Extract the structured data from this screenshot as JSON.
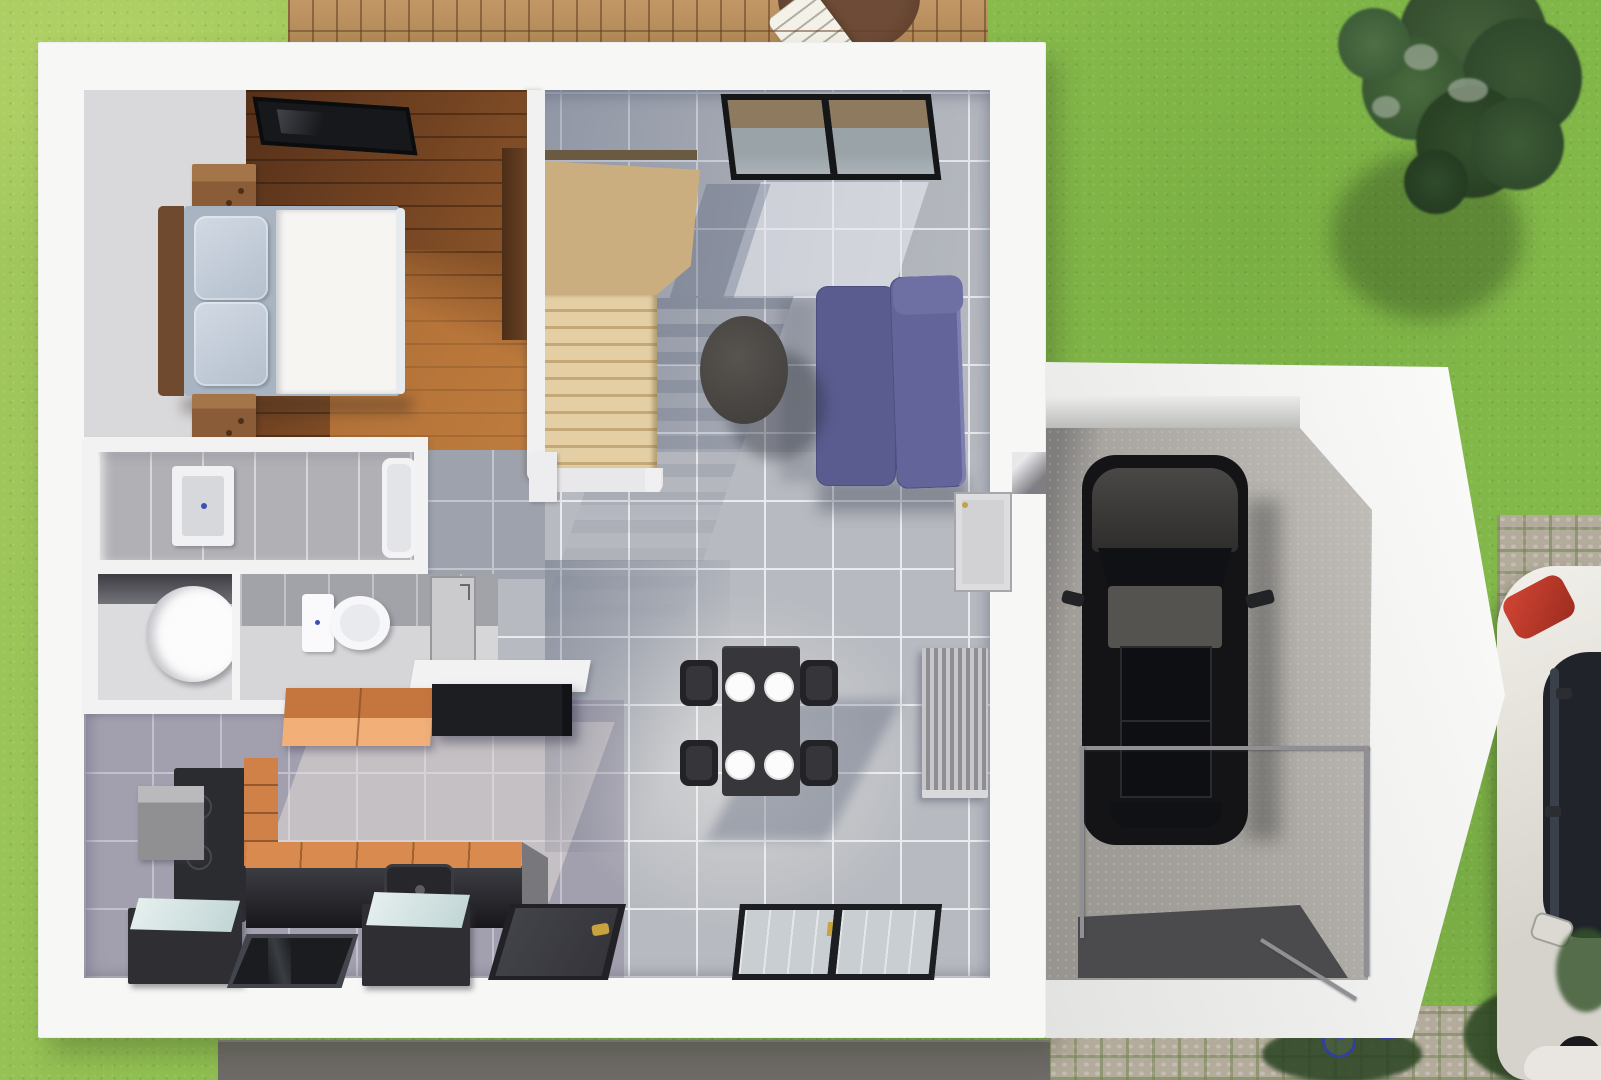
{
  "scene": {
    "type": "3d-floor-plan-render",
    "title": "Top-down 3D rendering of a house ground floor with attached garage, lawn, wooden deck and paved driveway",
    "palette": {
      "grass": "#8abc4e",
      "deck_wood": "#b9905f",
      "wall_white": "#f5f5f4",
      "bedroom_wood_floor": "#7b4b2a",
      "stairs_wood": "#d9c49c",
      "tile_living": "#b7bac0",
      "tile_shadow": "#8e96a8",
      "tile_kitchen": "#8f8b9e",
      "sofa_purple": "#5c5e92",
      "counter_orange": "#d98a4e",
      "counter_black": "#232327",
      "concrete": "#a7a49f",
      "cobblestone": "#b3ab9b",
      "black_car": "#141417",
      "white_car": "#ece9e4",
      "taillight_red": "#c43b2e",
      "tree_green": "#3a5233",
      "path_gray": "#6f6b68",
      "fixture_blue_dot": "#3d4fb5"
    },
    "areas": {
      "bedroom": {
        "label": "bedroom",
        "objects": [
          "double-bed",
          "pillows",
          "white-duvet",
          "nightstand",
          "nightstand",
          "wardrobe",
          "roof-window"
        ]
      },
      "staircase": {
        "label": "winder-staircase",
        "objects": [
          "wood-treads",
          "landing"
        ]
      },
      "living_dining": {
        "label": "living-dining-room",
        "objects": [
          "purple-sofa",
          "round-coffee-table",
          "dining-table",
          "four-chairs",
          "four-plates",
          "radiator",
          "sliding-window",
          "bottom-window",
          "front-door",
          "entry-door",
          "wall-niche"
        ]
      },
      "bathroom": {
        "label": "bathroom",
        "objects": [
          "shower-tray",
          "bathtub"
        ]
      },
      "utility": {
        "label": "utility-room",
        "objects": [
          "water-heater-cylinder"
        ]
      },
      "wc": {
        "label": "wc",
        "objects": [
          "toilet"
        ]
      },
      "kitchen": {
        "label": "kitchen",
        "objects": [
          "orange-wall-cabinet",
          "black-wall-cabinet",
          "cooktop-unit",
          "microwave-box",
          "drawer-cabinet",
          "counter-with-sink",
          "glass-top-appliance",
          "glass-top-appliance",
          "glass-floor-panel"
        ]
      },
      "garage": {
        "label": "garage",
        "objects": [
          "black-car",
          "concrete-floor",
          "glass-railing",
          "dark-mat"
        ]
      },
      "exterior": {
        "label": "exterior",
        "objects": [
          "lawn",
          "wooden-deck",
          "deck-table",
          "lounge-chair",
          "trees",
          "cobblestone-driveway",
          "white-car",
          "red-taillight",
          "bicycle",
          "gray-path",
          "bushes"
        ]
      }
    }
  }
}
